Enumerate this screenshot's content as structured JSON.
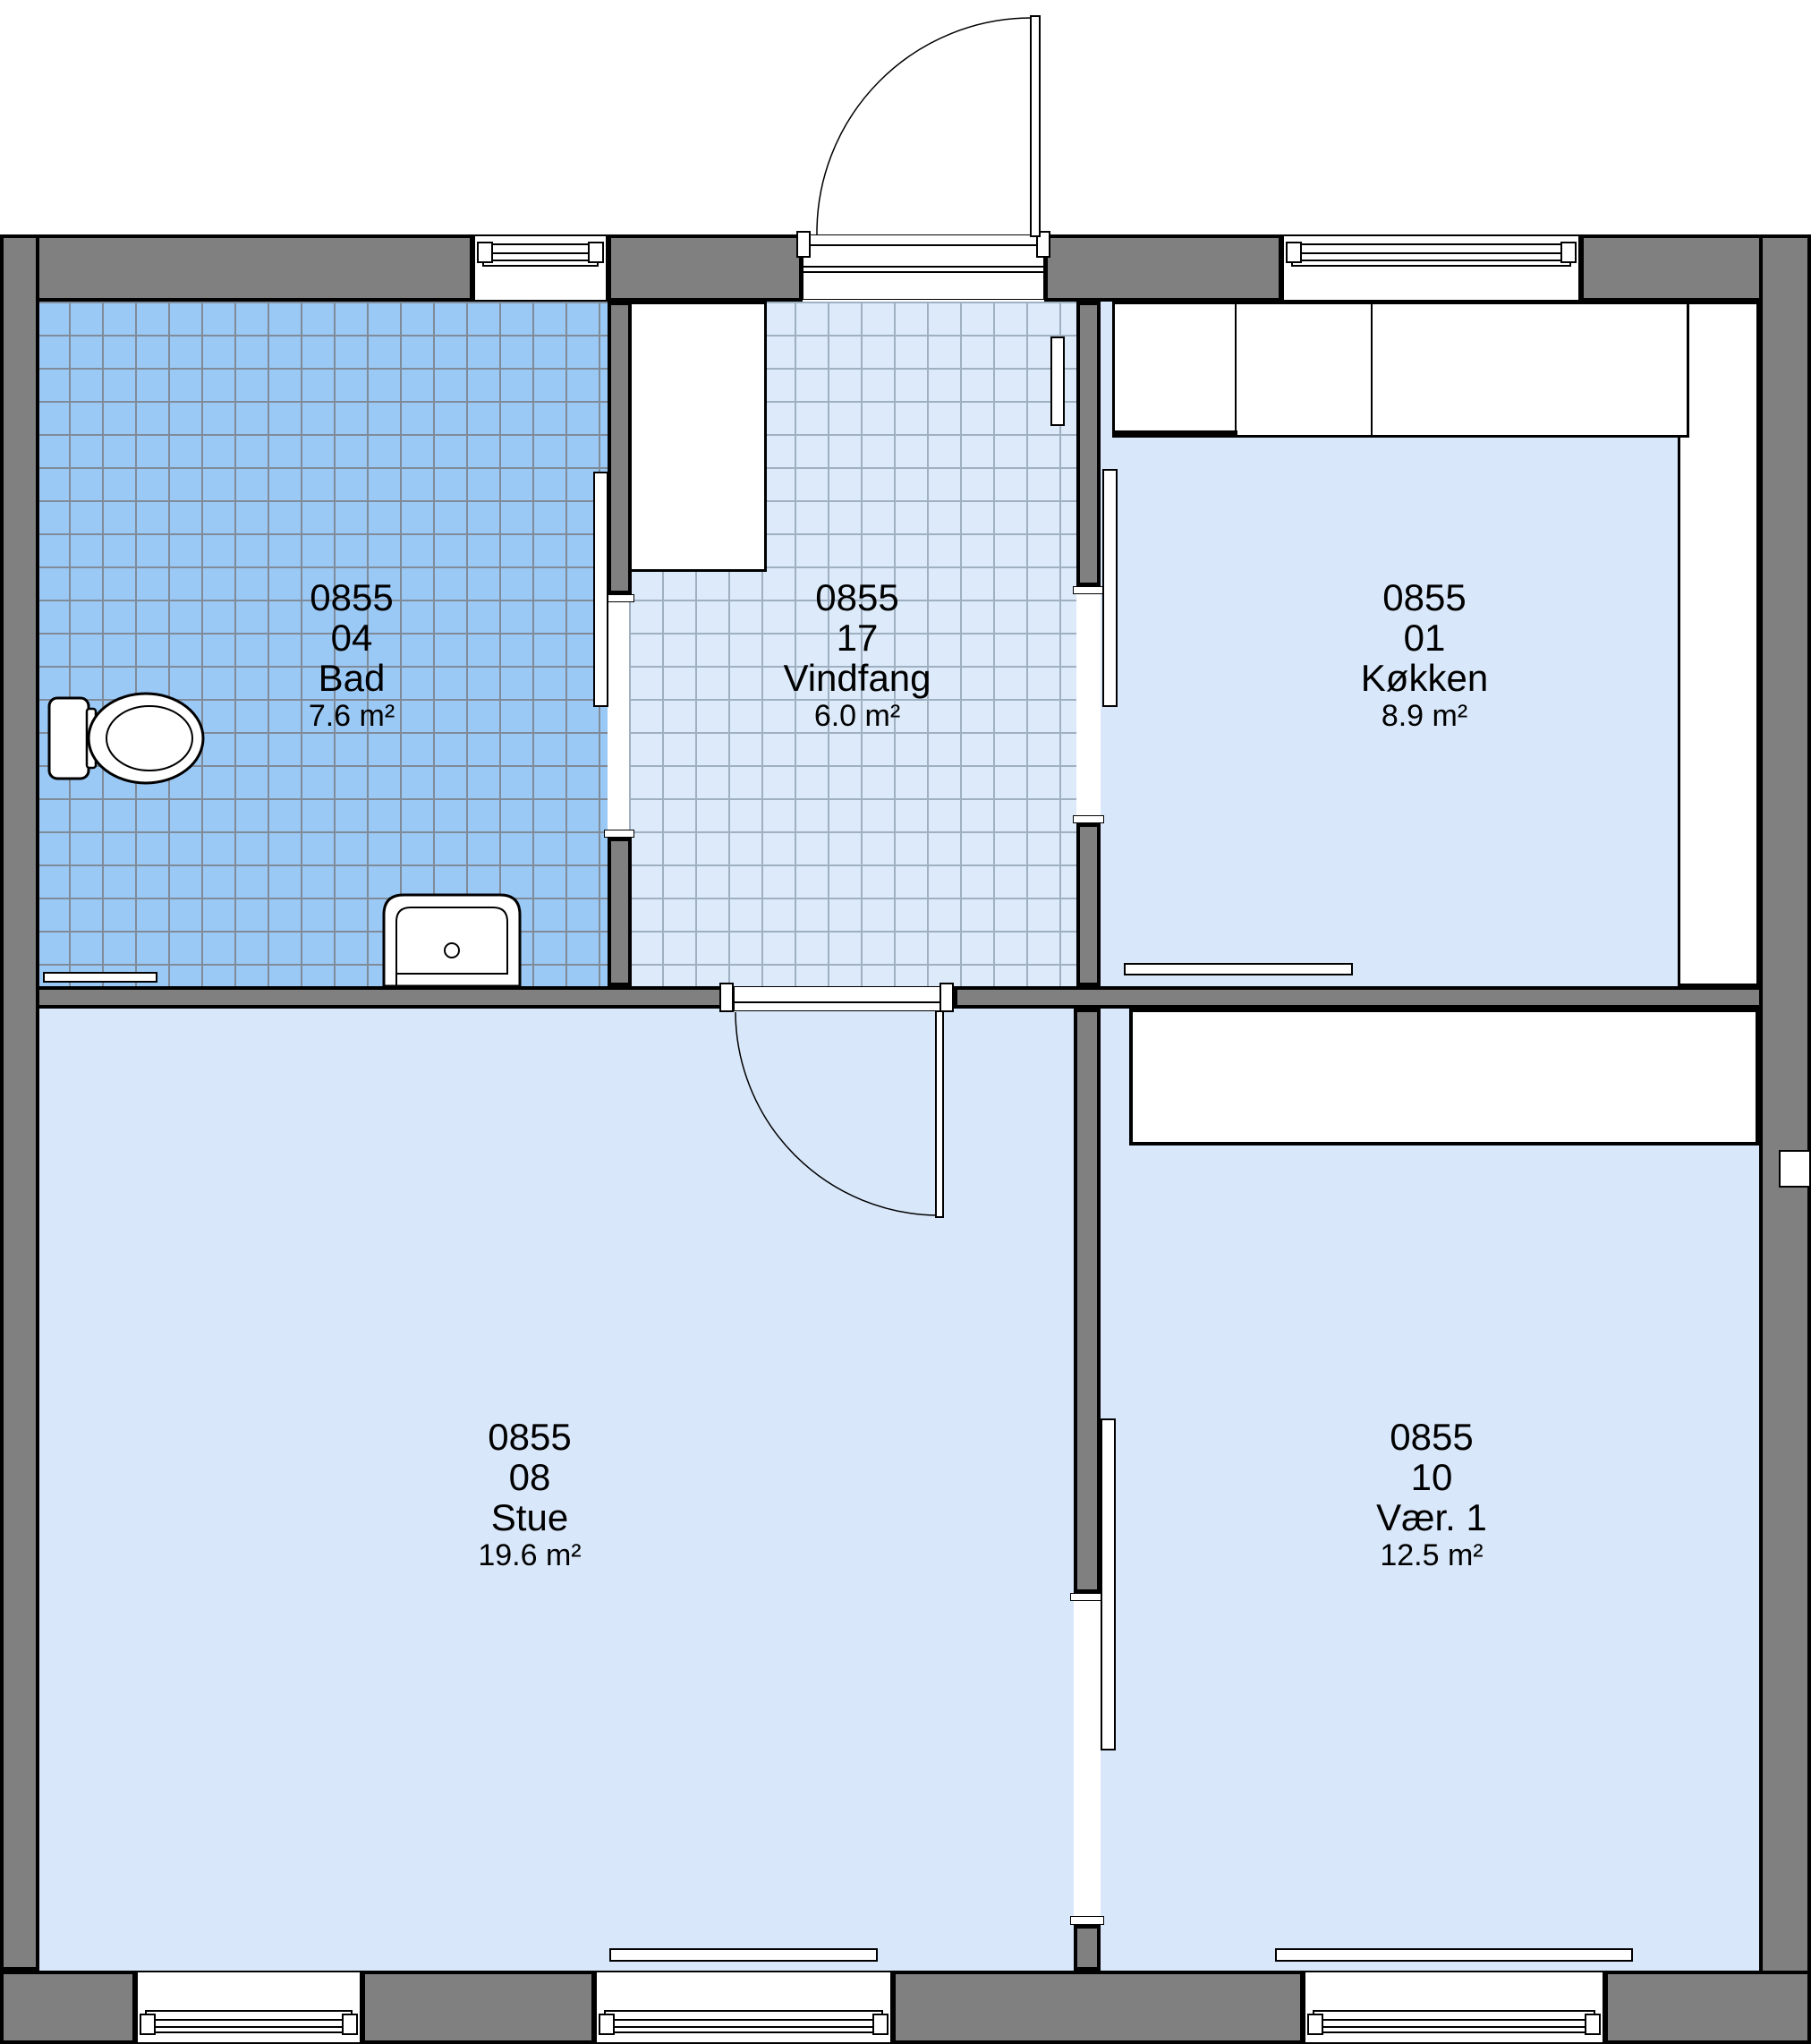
{
  "title": "Floor plan with room stamps (Danish)",
  "rooms": [
    {
      "key": "bad",
      "project": "0855",
      "number": "04",
      "name": "Bad",
      "area": "7.6 m²",
      "floor_finish": "tiled-blue"
    },
    {
      "key": "vindfang",
      "project": "0855",
      "number": "17",
      "name": "Vindfang",
      "area": "6.0 m²",
      "floor_finish": "tiled-light"
    },
    {
      "key": "kokken",
      "project": "0855",
      "number": "01",
      "name": "Køkken",
      "area": "8.9 m²",
      "floor_finish": "plain"
    },
    {
      "key": "stue",
      "project": "0855",
      "number": "08",
      "name": "Stue",
      "area": "19.6 m²",
      "floor_finish": "plain"
    },
    {
      "key": "vaer1",
      "project": "0855",
      "number": "10",
      "name": "Vær. 1",
      "area": "12.5 m²",
      "floor_finish": "plain"
    }
  ],
  "colors": {
    "wall_fill": "#808080",
    "outline": "#000000",
    "bad_tile": "#9bc9f6",
    "bad_tile_grid": "#7f8b99",
    "vindfang_tile": "#dceafa",
    "vindfang_tile_grid": "#9fb0c0",
    "floor": "#d8e7fa",
    "fixtures": "#ffffff",
    "background": "#ffffff"
  }
}
